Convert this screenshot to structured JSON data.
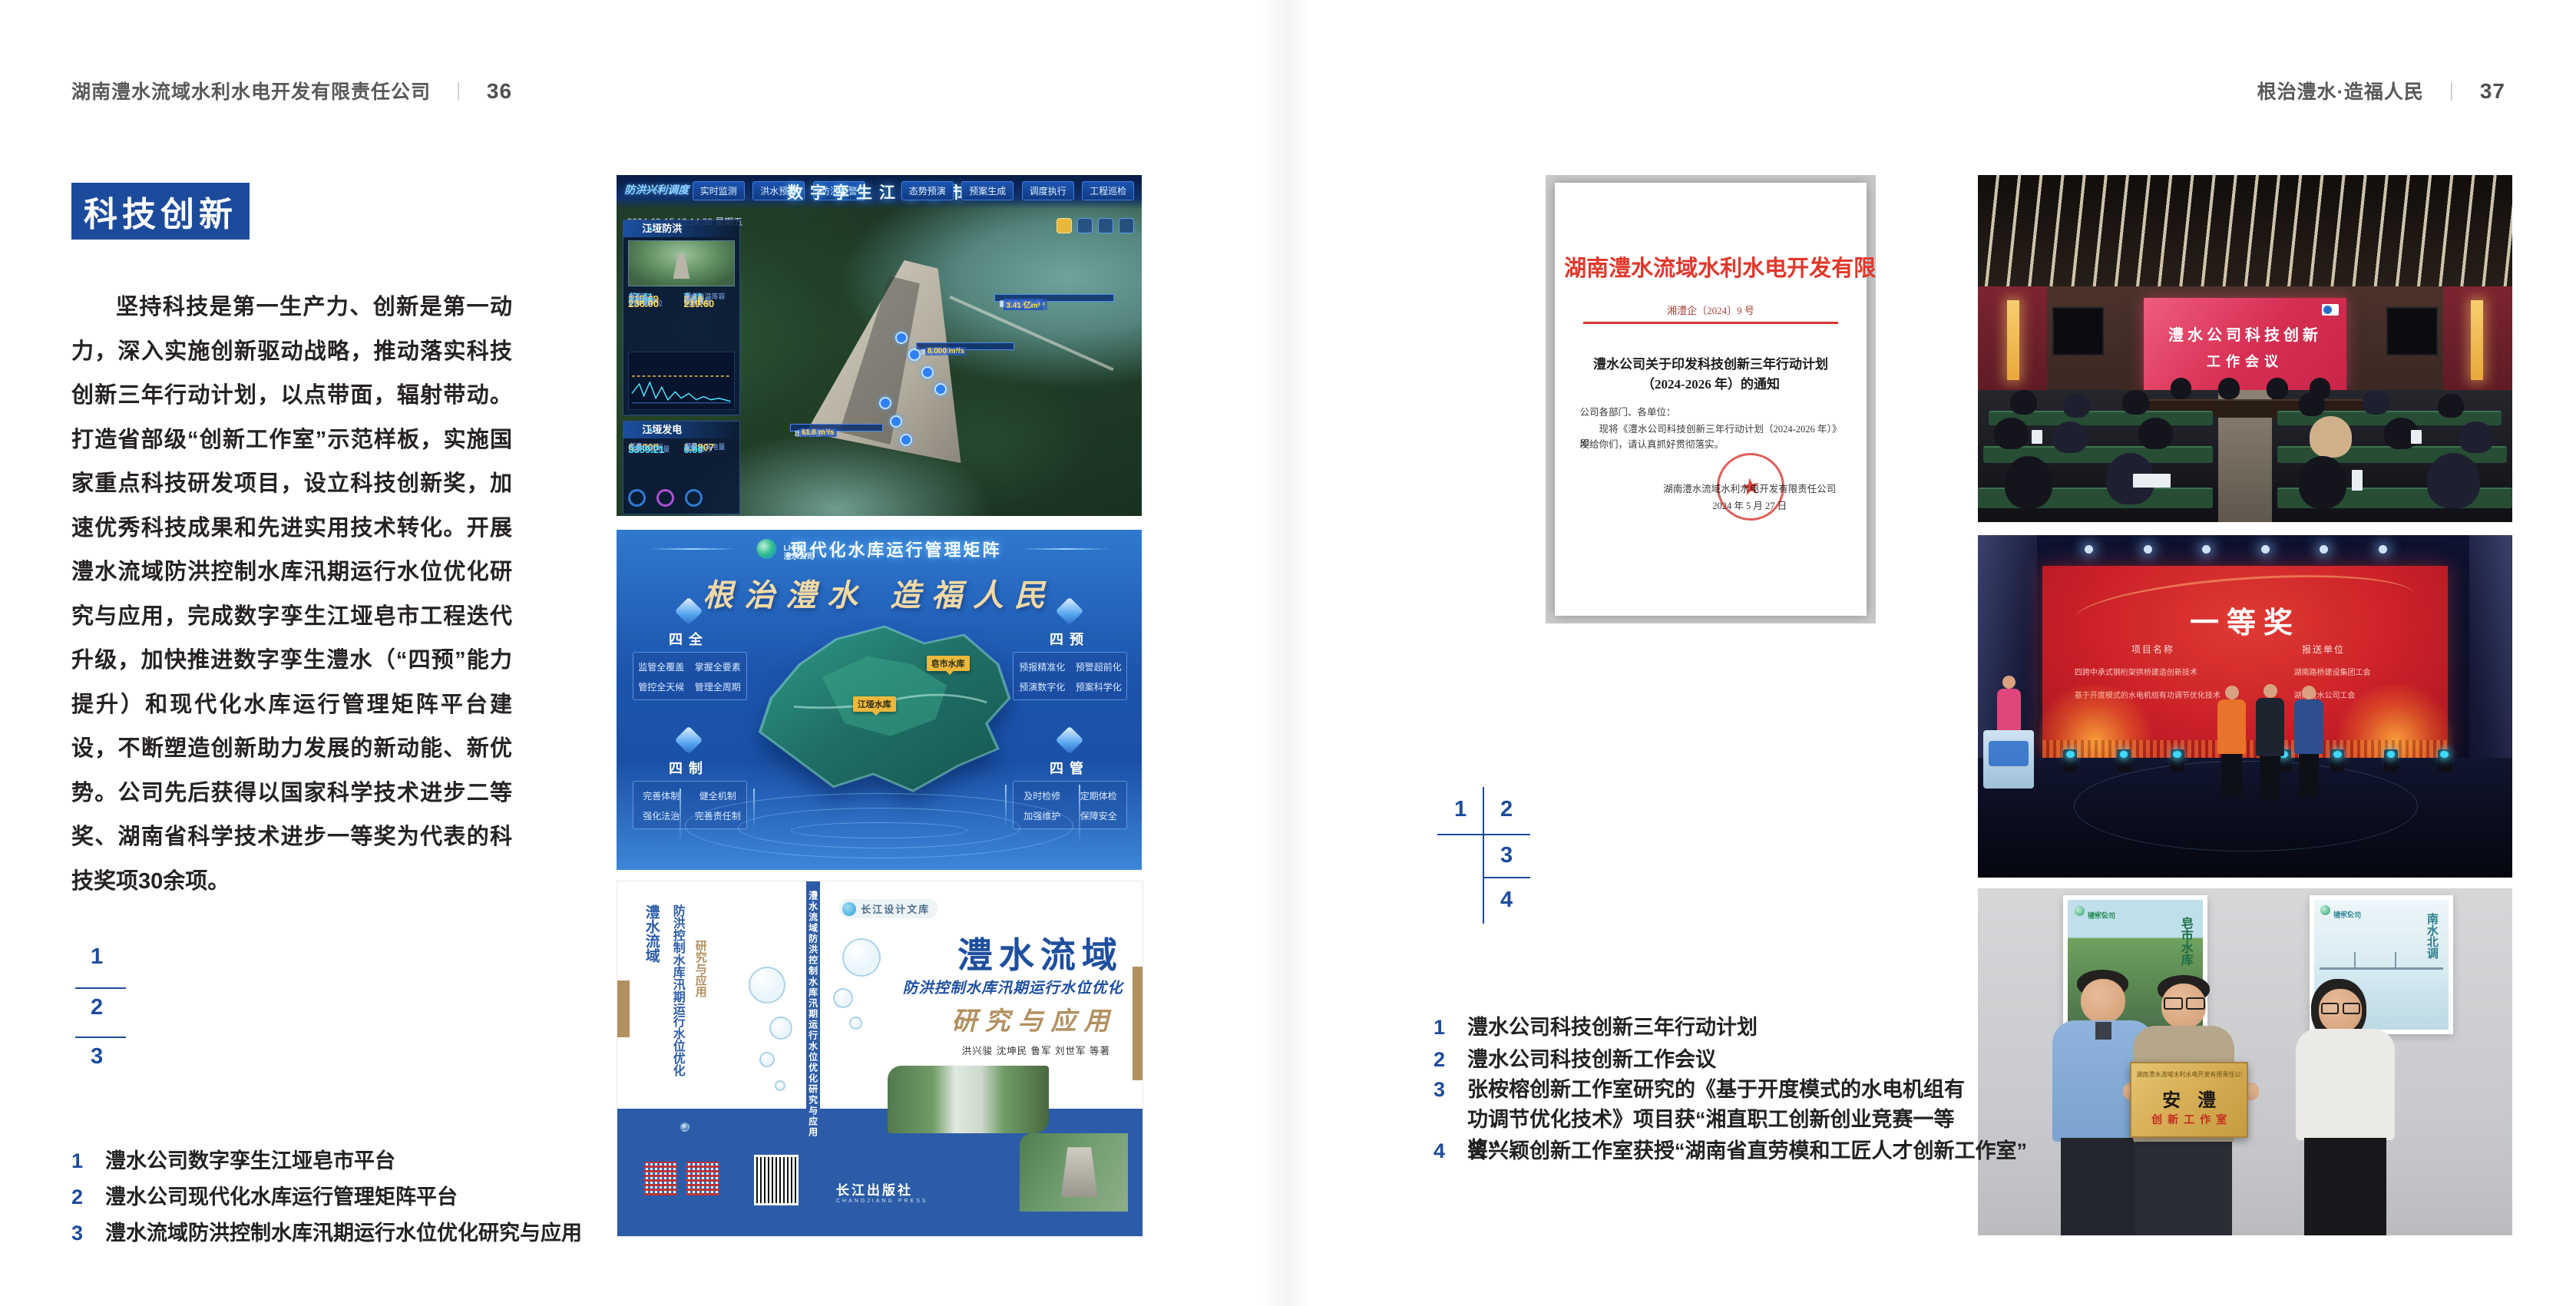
{
  "headers": {
    "left_company": "湖南澧水流域水利水电开发有限责任公司",
    "left_page": "36",
    "divider": "｜",
    "right_slogan": "根治澧水·造福人民",
    "right_page": "37"
  },
  "left": {
    "section_title": "科技创新",
    "paragraph": "坚持科技是第一生产力、创新是第一动力，深入实施创新驱动战略，推动落实科技创新三年行动计划，以点带面，辐射带动。打造省部级“创新工作室”示范样板，实施国家重点科技研发项目，设立科技创新奖，加速优秀科技成果和先进实用技术转化。开展澧水流域防洪控制水库汛期运行水位优化研究与应用，完成数字孪生江垭皂市工程迭代升级，加快推进数字孪生澧水（“四预”能力提升）和现代化水库运行管理矩阵平台建设，不断塑造创新助力发展的新动能、新优势。公司先后获得以国家科学技术进步二等奖、湖南省科学技术进步一等奖为代表的科技奖项30余项。",
    "index": [
      "1",
      "2",
      "3"
    ],
    "captions": [
      {
        "no": "1",
        "text": "澧水公司数字孪生江垭皂市平台"
      },
      {
        "no": "2",
        "text": "澧水公司现代化水库运行管理矩阵平台"
      },
      {
        "no": "3",
        "text": "澧水流域防洪控制水库汛期运行水位优化研究与应用"
      }
    ]
  },
  "right": {
    "index": [
      "1",
      "2",
      "3",
      "4"
    ],
    "captions": [
      {
        "no": "1",
        "text": "澧水公司科技创新三年行动计划"
      },
      {
        "no": "2",
        "text": "澧水公司科技创新工作会议"
      },
      {
        "no": "3",
        "text": "张桉榕创新工作室研究的《基于开度模式的水电机组有功调节优化技术》项目获“湘直职工创新创业竞赛一等奖”"
      },
      {
        "no": "4",
        "text": "曾兴颖创新工作室获授“湖南省直劳模和工匠人才创新工作室”"
      }
    ]
  },
  "twin": {
    "badge": "防洪兴利调度",
    "title": "数字孪生江垭皂市",
    "tabs_left": [
      "实时监测",
      "洪水预报",
      "防洪预警"
    ],
    "tabs_right": [
      "态势预演",
      "预案生成",
      "调度执行",
      "工程巡检"
    ],
    "timestamp": "2024-03-15 13:14:38 星期五",
    "flood": {
      "title": "江垭防洪",
      "stats": [
        {
          "l": "总库容",
          "v": "17.41",
          "u": "亿m³"
        },
        {
          "l": "剩余防洪库容",
          "v": "7.41",
          "u": "亿m³"
        },
        {
          "l": "坝上水位",
          "v": "215.69",
          "u": "m"
        },
        {
          "l": "蓄水量",
          "v": "8.10",
          "u": "亿m³"
        },
        {
          "l": "入库流量",
          "v": "0.000",
          "u": "m³/s"
        },
        {
          "l": "出库流量",
          "v": "61.8",
          "u": "m³/s"
        },
        {
          "l": "正常蓄水位",
          "v": "236.00",
          "u": "m"
        },
        {
          "l": "汛限水位",
          "v": "219.60",
          "u": "m"
        }
      ]
    },
    "power": {
      "title": "江垭发电",
      "stats": [
        {
          "l": "年发电计划",
          "v": "6.3000",
          "u": "亿度"
        },
        {
          "l": "年累计发电量",
          "v": "1.2907",
          "u": "亿度"
        },
        {
          "l": "月累计发电量",
          "v": "3359.21",
          "u": "万度"
        },
        {
          "l": "当前出力",
          "v": "0.00",
          "u": "MW"
        }
      ]
    },
    "co_up": [
      {
        "l": "坝上水位",
        "v": "236.69 m"
      },
      {
        "l": "入库流量",
        "v": "8.000 m³/s"
      }
    ],
    "co_right": [
      {
        "l": "总库容量",
        "v": "17.41 亿m³"
      },
      {
        "l": "蓄水量",
        "v": "8.10 亿m³"
      },
      {
        "l": "防洪库容",
        "v": "3.41 亿m³"
      },
      {
        "l": "剩余防洪库容",
        "v": "3.41 亿m³"
      }
    ],
    "co_down": [
      {
        "l": "坝下水位",
        "v": "186.19 m"
      },
      {
        "l": "出库流量",
        "v": "61.8 m³/s"
      }
    ]
  },
  "matrix": {
    "logo_top": "LHPC",
    "logo_sub": "澧水公司",
    "title": "现代化水库运行管理矩阵",
    "slogan": "根治澧水 造福人民",
    "panels": [
      {
        "title": "四全",
        "items": [
          "监管全覆盖",
          "掌握全要素",
          "管控全天候",
          "管理全周期"
        ]
      },
      {
        "title": "四预",
        "items": [
          "预报精准化",
          "预警超前化",
          "预演数字化",
          "预案科学化"
        ]
      },
      {
        "title": "四制",
        "items": [
          "完善体制",
          "健全机制",
          "强化法治",
          "完善责任制"
        ]
      },
      {
        "title": "四管",
        "items": [
          "及时检修",
          "定期体检",
          "加强维护",
          "保障安全"
        ]
      }
    ],
    "tag_zaoshi": "皂市水库",
    "tag_jiangya": "江垭水库"
  },
  "book": {
    "brand": "长江设计文库",
    "title1": "澧水流域",
    "title2": "防洪控制水库汛期运行水位优化",
    "title3": "研究与应用",
    "authors": "洪兴骏  沈坤民  鲁军  刘世军  等著",
    "publisher": "长江出版社",
    "publisher_en": "CHANGJIANG PRESS",
    "spine": "澧水流域防洪控制水库汛期运行水位优化研究与应用"
  },
  "docu": {
    "header": "湖南澧水流域水利水电开发有限责任公司文件",
    "number": "湘澧企〔2024〕9 号",
    "title1": "澧水公司关于印发科技创新三年行动计划",
    "title2": "（2024-2026 年）的通知",
    "salutation": "公司各部门、各单位：",
    "body1": "现将《澧水公司科技创新三年行动计划（2024-2026 年）》印",
    "body2": "发给你们，请认真抓好贯彻落实。",
    "sign1": "湖南澧水流域水利水电开发有限责任公司",
    "sign2": "2024 年 5 月 27 日",
    "stamp_star": "★"
  },
  "meeting": {
    "line1": "澧水公司科技创新",
    "line2": "工作会议"
  },
  "award": {
    "title": "一等奖",
    "col1": "项目名称",
    "col2": "报送单位",
    "rows": [
      {
        "p": "四跨中承式钢桁架拱桥建造创新技术",
        "o": "湖南路桥建设集团工会"
      },
      {
        "p": "基于开度模式的水电机组有功调节优化技术",
        "o": "湖南澧水公司工会"
      }
    ]
  },
  "group": {
    "plaque_header": "湖南澧水流域水利水电开发有限责任公司",
    "plaque_title": "安澧",
    "plaque_sub": "创新工作室",
    "poster_left_label": "皂市水库",
    "poster_right_label": "南水北调",
    "poster_logo_top": "LHPC",
    "poster_logo_sub": "澧水公司"
  }
}
